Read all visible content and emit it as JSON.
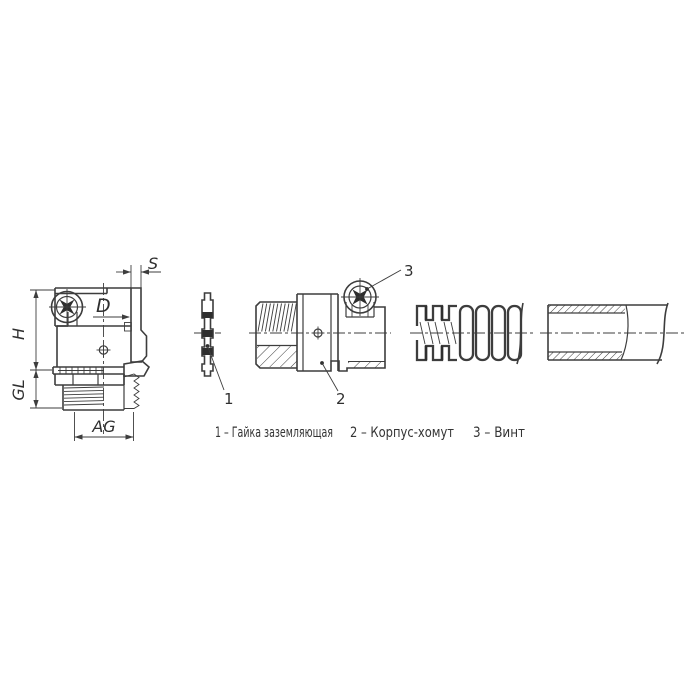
{
  "drawing": {
    "colors": {
      "line": "#3d3d3d",
      "text": "#2f2f2f",
      "background": "#ffffff"
    },
    "labels": {
      "s": "S",
      "d": "D",
      "h": "H",
      "gl": "GL",
      "ag": "AG"
    },
    "callouts": {
      "c1": "1",
      "c2": "2",
      "c3": "3"
    },
    "legend": {
      "item1": "1 – Гайка заземляющая",
      "item2": "2 – Корпус-хомут",
      "item3": "3 – Винт"
    }
  }
}
